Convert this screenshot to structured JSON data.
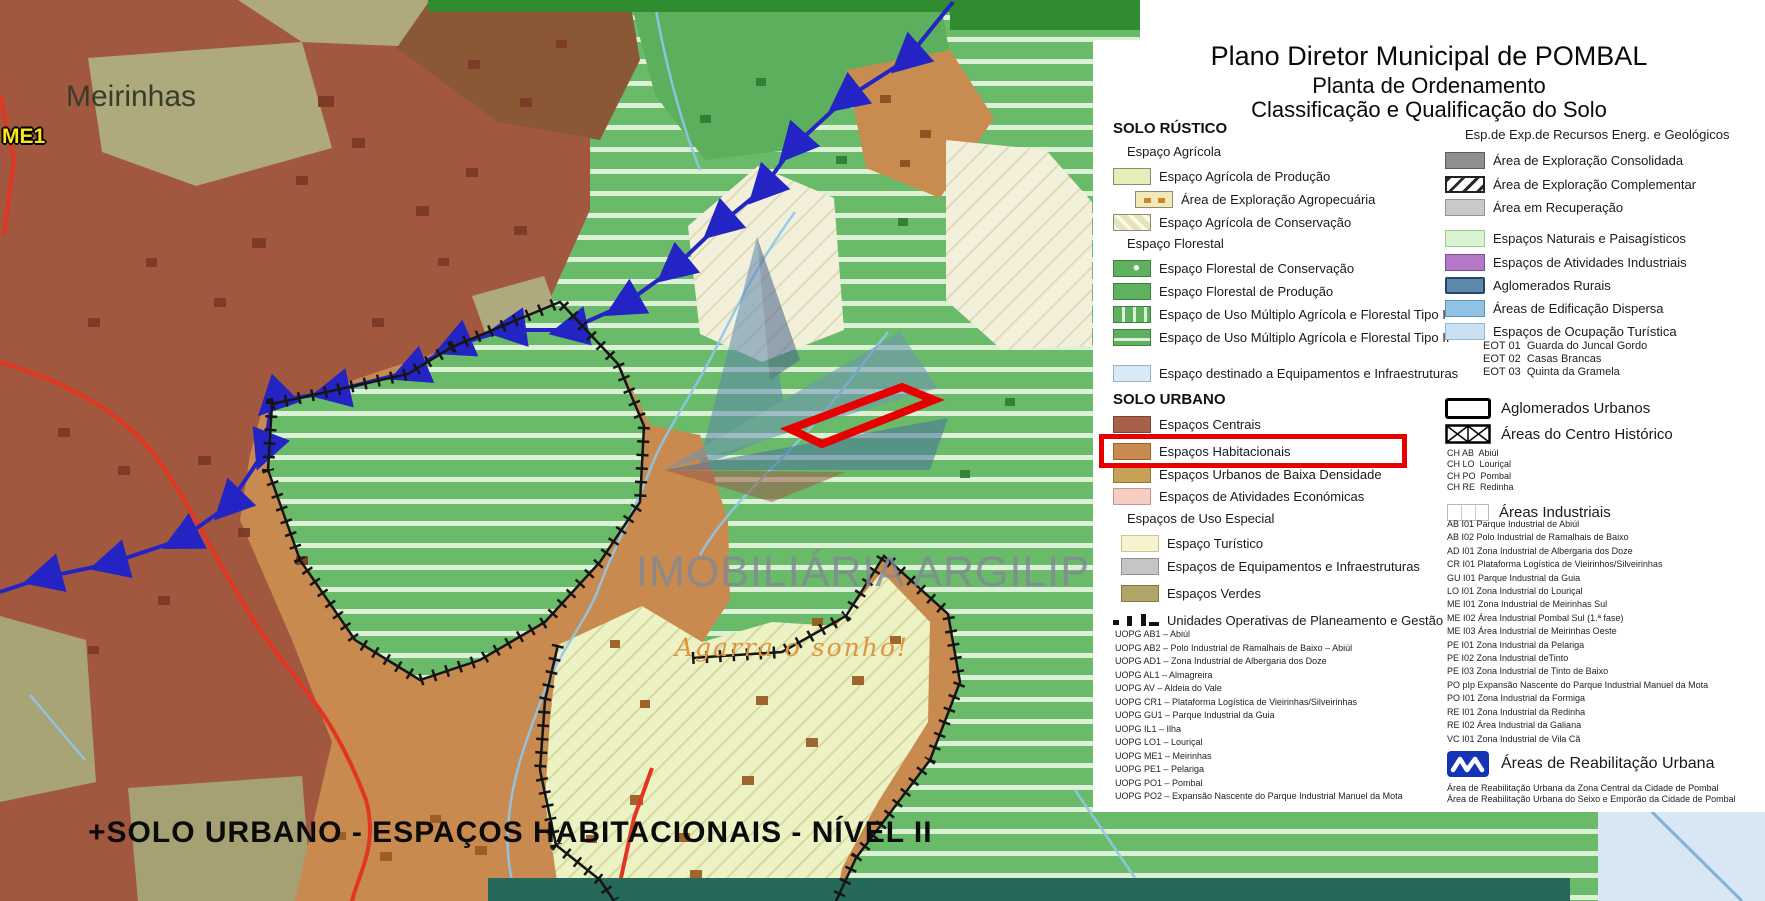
{
  "title": {
    "line1": "Plano Diretor Municipal de POMBAL",
    "line2": "Planta de Ordenamento",
    "line3": "Classificação e Qualificação do Solo"
  },
  "map": {
    "place_label": "Meirinhas",
    "code_label": "ME1",
    "caption": "+SOLO URBANO - ESPAÇOS HABITACIONAIS - NÍVEL II",
    "watermark": {
      "brand": "IMOBILIÁRIA ARGILIPE",
      "slogan": "Agarra o sonho!"
    }
  },
  "legend_left": {
    "h_rustico": "SOLO RÚSTICO",
    "sub_agricola": "Espaço Agrícola",
    "agri_prod": "Espaço Agrícola de Produção",
    "agropecuaria": "Área de Exploração Agropecuária",
    "agri_cons": "Espaço Agrícola de Conservação",
    "sub_florestal": "Espaço Florestal",
    "flor_cons": "Espaço Florestal de Conservação",
    "flor_prod": "Espaço Florestal de Produção",
    "multiplo1": "Espaço de Uso Múltiplo Agrícola e Florestal Tipo I",
    "multiplo2": "Espaço de Uso Múltiplo Agrícola e Florestal Tipo II",
    "equip_infra": "Espaço destinado a Equipamentos e Infraestruturas",
    "h_urbano": "SOLO URBANO",
    "centrais": "Espaços Centrais",
    "habitacionais": "Espaços Habitacionais",
    "baixa_densidade": "Espaços Urbanos de Baixa Densidade",
    "atividades_economicas": "Espaços de Atividades Económicas",
    "sub_uso_especial": "Espaços de Uso Especial",
    "turistico": "Espaço Turístico",
    "equipamentos": "Espaços de Equipamentos e Infraestruturas",
    "verdes": "Espaços Verdes",
    "uopg_label": "Unidades Operativas de Planeamento e Gestão",
    "uopg_list": [
      "UOPG AB1 – Abiúl",
      "UOPG AB2 – Polo Industrial de Ramalhais de Baixo – Abiúl",
      "UOPG AD1 – Zona Industrial de Albergaria dos Doze",
      "UOPG AL1 – Almagreira",
      "UOPG AV – Aldeia do Vale",
      "UOPG CR1 – Plataforma Logística de Vieirinhas/Silveirinhas",
      "UOPG GU1 – Parque Industrial da Guia",
      "UOPG IL1 – Ilha",
      "UOPG LO1 – Louriçal",
      "UOPG ME1 – Meirinhas",
      "UOPG PE1 – Pelariga",
      "UOPG PO1 – Pombal",
      "UOPG PO2 – Expansão Nascente do Parque Industrial Manuel da Mota"
    ]
  },
  "legend_right": {
    "h_recursos": "Esp.de Exp.de Recursos Energ. e Geológicos",
    "consolidada": "Área de Exploração Consolidada",
    "complementar": "Área de Exploração Complementar",
    "recuperacao": "Área em Recuperação",
    "naturais": "Espaços Naturais e Paisagísticos",
    "atividades_industriais": "Espaços de Atividades Industriais",
    "aglomerados_rurais": "Aglomerados Rurais",
    "edificacao_dispersa": "Áreas de Edificação Dispersa",
    "ocupacao_turistica": "Espaços de Ocupação Turística",
    "eot_list": [
      "EOT 01  Guarda do Juncal Gordo",
      "EOT 02  Casas Brancas",
      "EOT 03  Quinta da Gramela"
    ],
    "aglomerados_urbanos": "Aglomerados Urbanos",
    "centro_historico": "Áreas do Centro Histórico",
    "ch_list": [
      "CH AB  Abiúl",
      "CH LO  Louriçal",
      "CH PO  Pombal",
      "CH RE  Redinha"
    ],
    "h_industriais": "Áreas Industriais",
    "industrial_list": [
      "AB I01 Parque Industrial de Abiúl",
      "AB I02 Polo Industrial de Ramalhais de Baixo",
      "AD I01 Zona Industrial de Albergaria dos Doze",
      "CR I01 Plataforma Logística de Vieirinhos/Silveirinhas",
      "GU I01 Parque Industrial da Guia",
      "LO I01 Zona Industrial do Louriçal",
      "ME I01 Zona Industrial de Meirinhas Sul",
      "ME I02 Área Industrial Pombal Sul (1.ª fase)",
      "ME I03 Área Industrial de Meirinhas Oeste",
      "PE I01 Zona Industrial da Pelariga",
      "PE I02 Zona Industrial deTinto",
      "PE I03 Zona Industrial de Tinto de Baixo",
      "PO pIp Expansão Nascente do Parque Industrial Manuel da Mota",
      "PO I01 Zona Industrial da Formiga",
      "RE I01 Zona Industrial da Redinha",
      "RE I02 Área Industrial da Galiana",
      "VC I01 Zona Industrial de Vila Cã"
    ],
    "h_reabilitacao": "Áreas de Reabilitação Urbana",
    "aru_list": [
      "Área de Reabilitação Urbana da Zona Central da Cidade de Pombal",
      "Área de Reabilitação Urbana do Seixo e Emporão da Cidade de Pombal"
    ]
  },
  "colors": {
    "highlight_box": "#E60000",
    "panel_bg": "#FFFFFF",
    "boundary_blue": "#2424C4",
    "espacos_centrais": "#A8604A",
    "espacos_habitacionais": "#C98A4F",
    "baixa_densidade": "#C7A158",
    "atividades_economicas": "#F6CDC1",
    "agricola_producao": "#E2EFB9",
    "florestal": "#5FB05F",
    "equip_infra_rustico": "#D9E9F6",
    "turistico": "#F7F3CE",
    "equipamentos": "#C5C5C5",
    "verdes": "#B2A368",
    "naturais": "#D9F3D1",
    "atividades_industriais": "#B478C6",
    "aglomerados_rurais": "#5E88AC",
    "edificacao_dispersa": "#8FC2E4",
    "ocupacao_turistica": "#C9E1F2",
    "watermark_orange": "#DF9440"
  }
}
